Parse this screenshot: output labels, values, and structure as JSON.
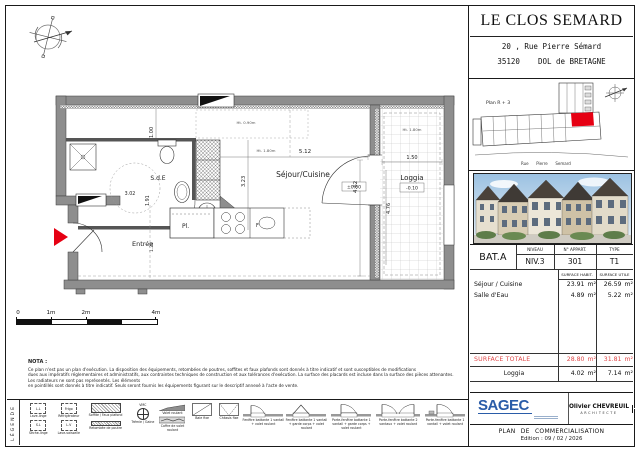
{
  "doc": {
    "project": "LE CLOS SEMARD",
    "address_line1": "20 , Rue Pierre Sémard",
    "address_line2": "35120    DOL de BRETAGNE"
  },
  "site_plan": {
    "label": "Plan R + 3",
    "street": "Rue      Pierre      Semard"
  },
  "unit_table": {
    "bat": "BAT.A",
    "col_niveau": "NIVEAU",
    "col_appart": "N° APPART.",
    "col_type": "TYPE",
    "niveau": "NIV.3",
    "appart": "301",
    "type": "T1",
    "col_habit": "SURFACE HABIT.",
    "col_utile": "SURFACE UTILE",
    "rows": [
      {
        "label": "Séjour / Cuisine",
        "habit": "23.91",
        "utile": "26.59"
      },
      {
        "label": "Salle d'Eau",
        "habit": "4.89",
        "utile": "5.22"
      }
    ],
    "total": {
      "label": "SURFACE TOTALE",
      "habit": "28.80",
      "utile": "31.81"
    },
    "loggia": {
      "label": "Loggia",
      "habit": "4.02",
      "utile": "7.14"
    },
    "unit": "m²"
  },
  "plan": {
    "rooms": {
      "sejour": "Séjour/Cuisine",
      "sde": "S.d.E",
      "entree": "Entrée",
      "pl": "Pl.",
      "loggia": "Loggia"
    },
    "dims": {
      "d100": "1.00",
      "d302": "3.02",
      "d191": "1.91",
      "d323": "3.23",
      "d512": "5.12",
      "d462": "4.62",
      "d150": "1.50",
      "d476": "4.76",
      "d122": "1.22"
    },
    "levels": {
      "zero": "±0.00",
      "minus": "-0.10"
    },
    "heights": {
      "h090": "Ht. 0.90m",
      "h180": "Ht. 1.80m"
    },
    "kitchen_f": "F"
  },
  "scale_bar": {
    "t0": "0",
    "t1": "1m",
    "t2": "2m",
    "t4": "4m"
  },
  "nota": {
    "title": "NOTA :",
    "line1": "Ce plan n'est pas un plan d'exécution. La disposition des équipements, retombées de poutres, soffites et faux plafonds sont donnés à titre indicatif et sont susceptibles de modifications",
    "line2": "dues aux impératifs réglementaires et administratifs, aux contraintes techniques de construction et aux tolérances d'exécution. La surface des placards est incluse dans la surface des pièces attenantes. Les radiateurs ne sont pas représentés. Les éléments",
    "line3": "en pointillés sont donnés à titre indicatif. Seuls seront fournis les équipements figurant sur le descriptif annexé à l'acte de vente."
  },
  "legend": {
    "title": "LÉGENDE",
    "vmc": "VMC",
    "boxes": [
      {
        "abbr": "L.L",
        "label": "Lave-linge"
      },
      {
        "abbr": "Frigo",
        "label": "Réfrigérateur"
      },
      {
        "abbr": "S.L",
        "label": "Sèche-linge"
      },
      {
        "abbr": "L.V",
        "label": "Lave-vaisselle"
      }
    ],
    "items": [
      {
        "label": "Soffite / Faux plafond"
      },
      {
        "label": "Retombée de poutre"
      },
      {
        "label": "Trémie / Gaine"
      },
      {
        "label": "Volet roulant"
      },
      {
        "label": "Coffre de volet roulant"
      },
      {
        "label": "Baie fixe"
      },
      {
        "label": "Châssis fixe"
      },
      {
        "label": "Fenêtre battante 1 vantail + volet roulant"
      },
      {
        "label": "Fenêtre battante 1 vantail + garde corps + volet roulant"
      },
      {
        "label": "Porte-fenêtre battante 1 vantail + garde corps + volet roulant"
      },
      {
        "label": "Porte-fenêtre battante 2 vantaux + volet roulant"
      },
      {
        "label": "Porte-fenêtre battante 1 vantail + volet roulant"
      }
    ]
  },
  "footer": {
    "sagec": "SAGEC",
    "architect_name": "Olivier CHEVREUIL",
    "architect_title": "ARCHITECTE",
    "doc_title": "PLAN DE COMMERCIALISATION",
    "edition": "Edition : 09 / 02 / 2026"
  },
  "colors": {
    "accent_red": "#e60013",
    "total_red": "#e04848",
    "sagec_blue": "#2a5ca8",
    "wall_gray": "#8e8e8e"
  }
}
